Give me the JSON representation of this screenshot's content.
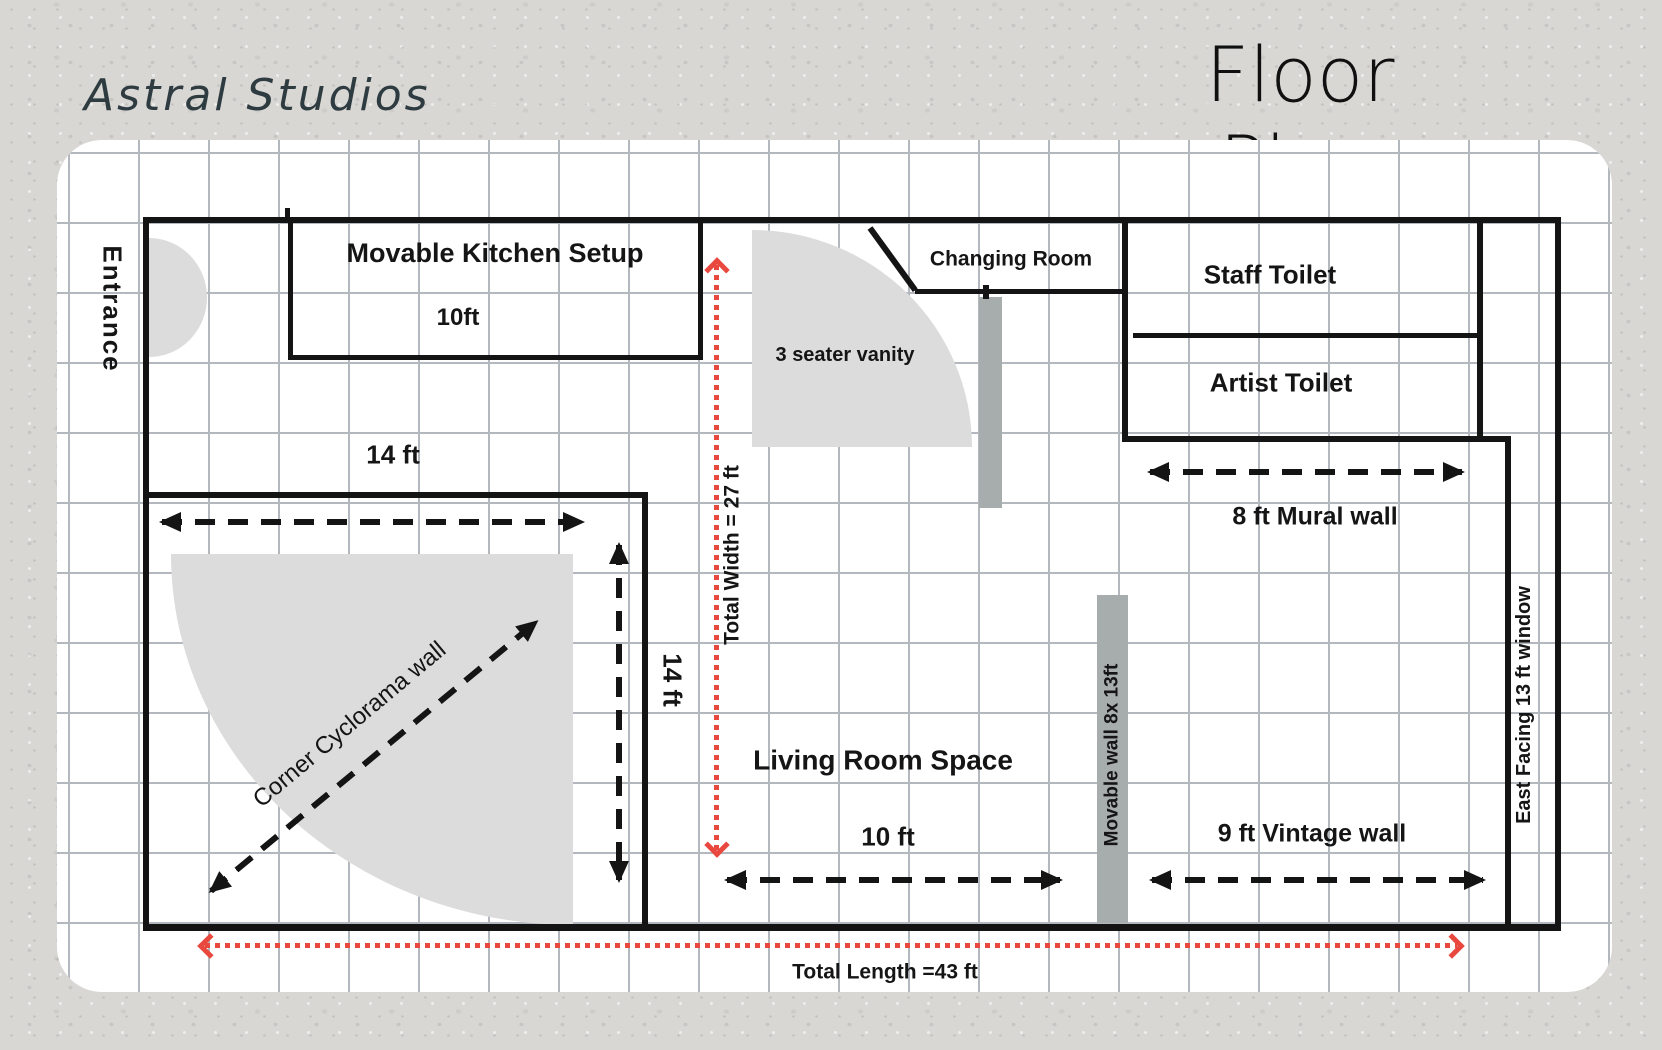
{
  "header": {
    "brand": "Astral Studios",
    "title": "Floor Plan"
  },
  "plan": {
    "entrance_label": "Entrance",
    "kitchen": {
      "title": "Movable Kitchen Setup",
      "size": "10ft"
    },
    "changing_room_label": "Changing Room",
    "vanity_label": "3 seater vanity",
    "staff_toilet_label": "Staff Toilet",
    "artist_toilet_label": "Artist Toilet",
    "mural_wall_label": "8 ft Mural wall",
    "vintage_wall_label": "9 ft Vintage wall",
    "east_window_label": "East Facing 13 ft window",
    "movable_wall_label": "Movable wall 8x 13ft",
    "living_room": {
      "title": "Living Room Space",
      "size": "10 ft"
    },
    "cyclorama": {
      "diagonal_label": "Corner Cyclorama wall",
      "width_label": "14 ft",
      "height_label": "14 ft"
    },
    "totals": {
      "width_label": "Total Width = 27 ft",
      "length_label": "Total Length =43 ft"
    }
  },
  "colors": {
    "accent_red": "#e8483e",
    "wall_black": "#141414",
    "room_fill_gray": "#dcdcdc",
    "bar_gray": "#a7acac",
    "grid_gray": "#b3b8be",
    "brand_text": "#2e3b40",
    "page_background": "#d8d7d4"
  }
}
